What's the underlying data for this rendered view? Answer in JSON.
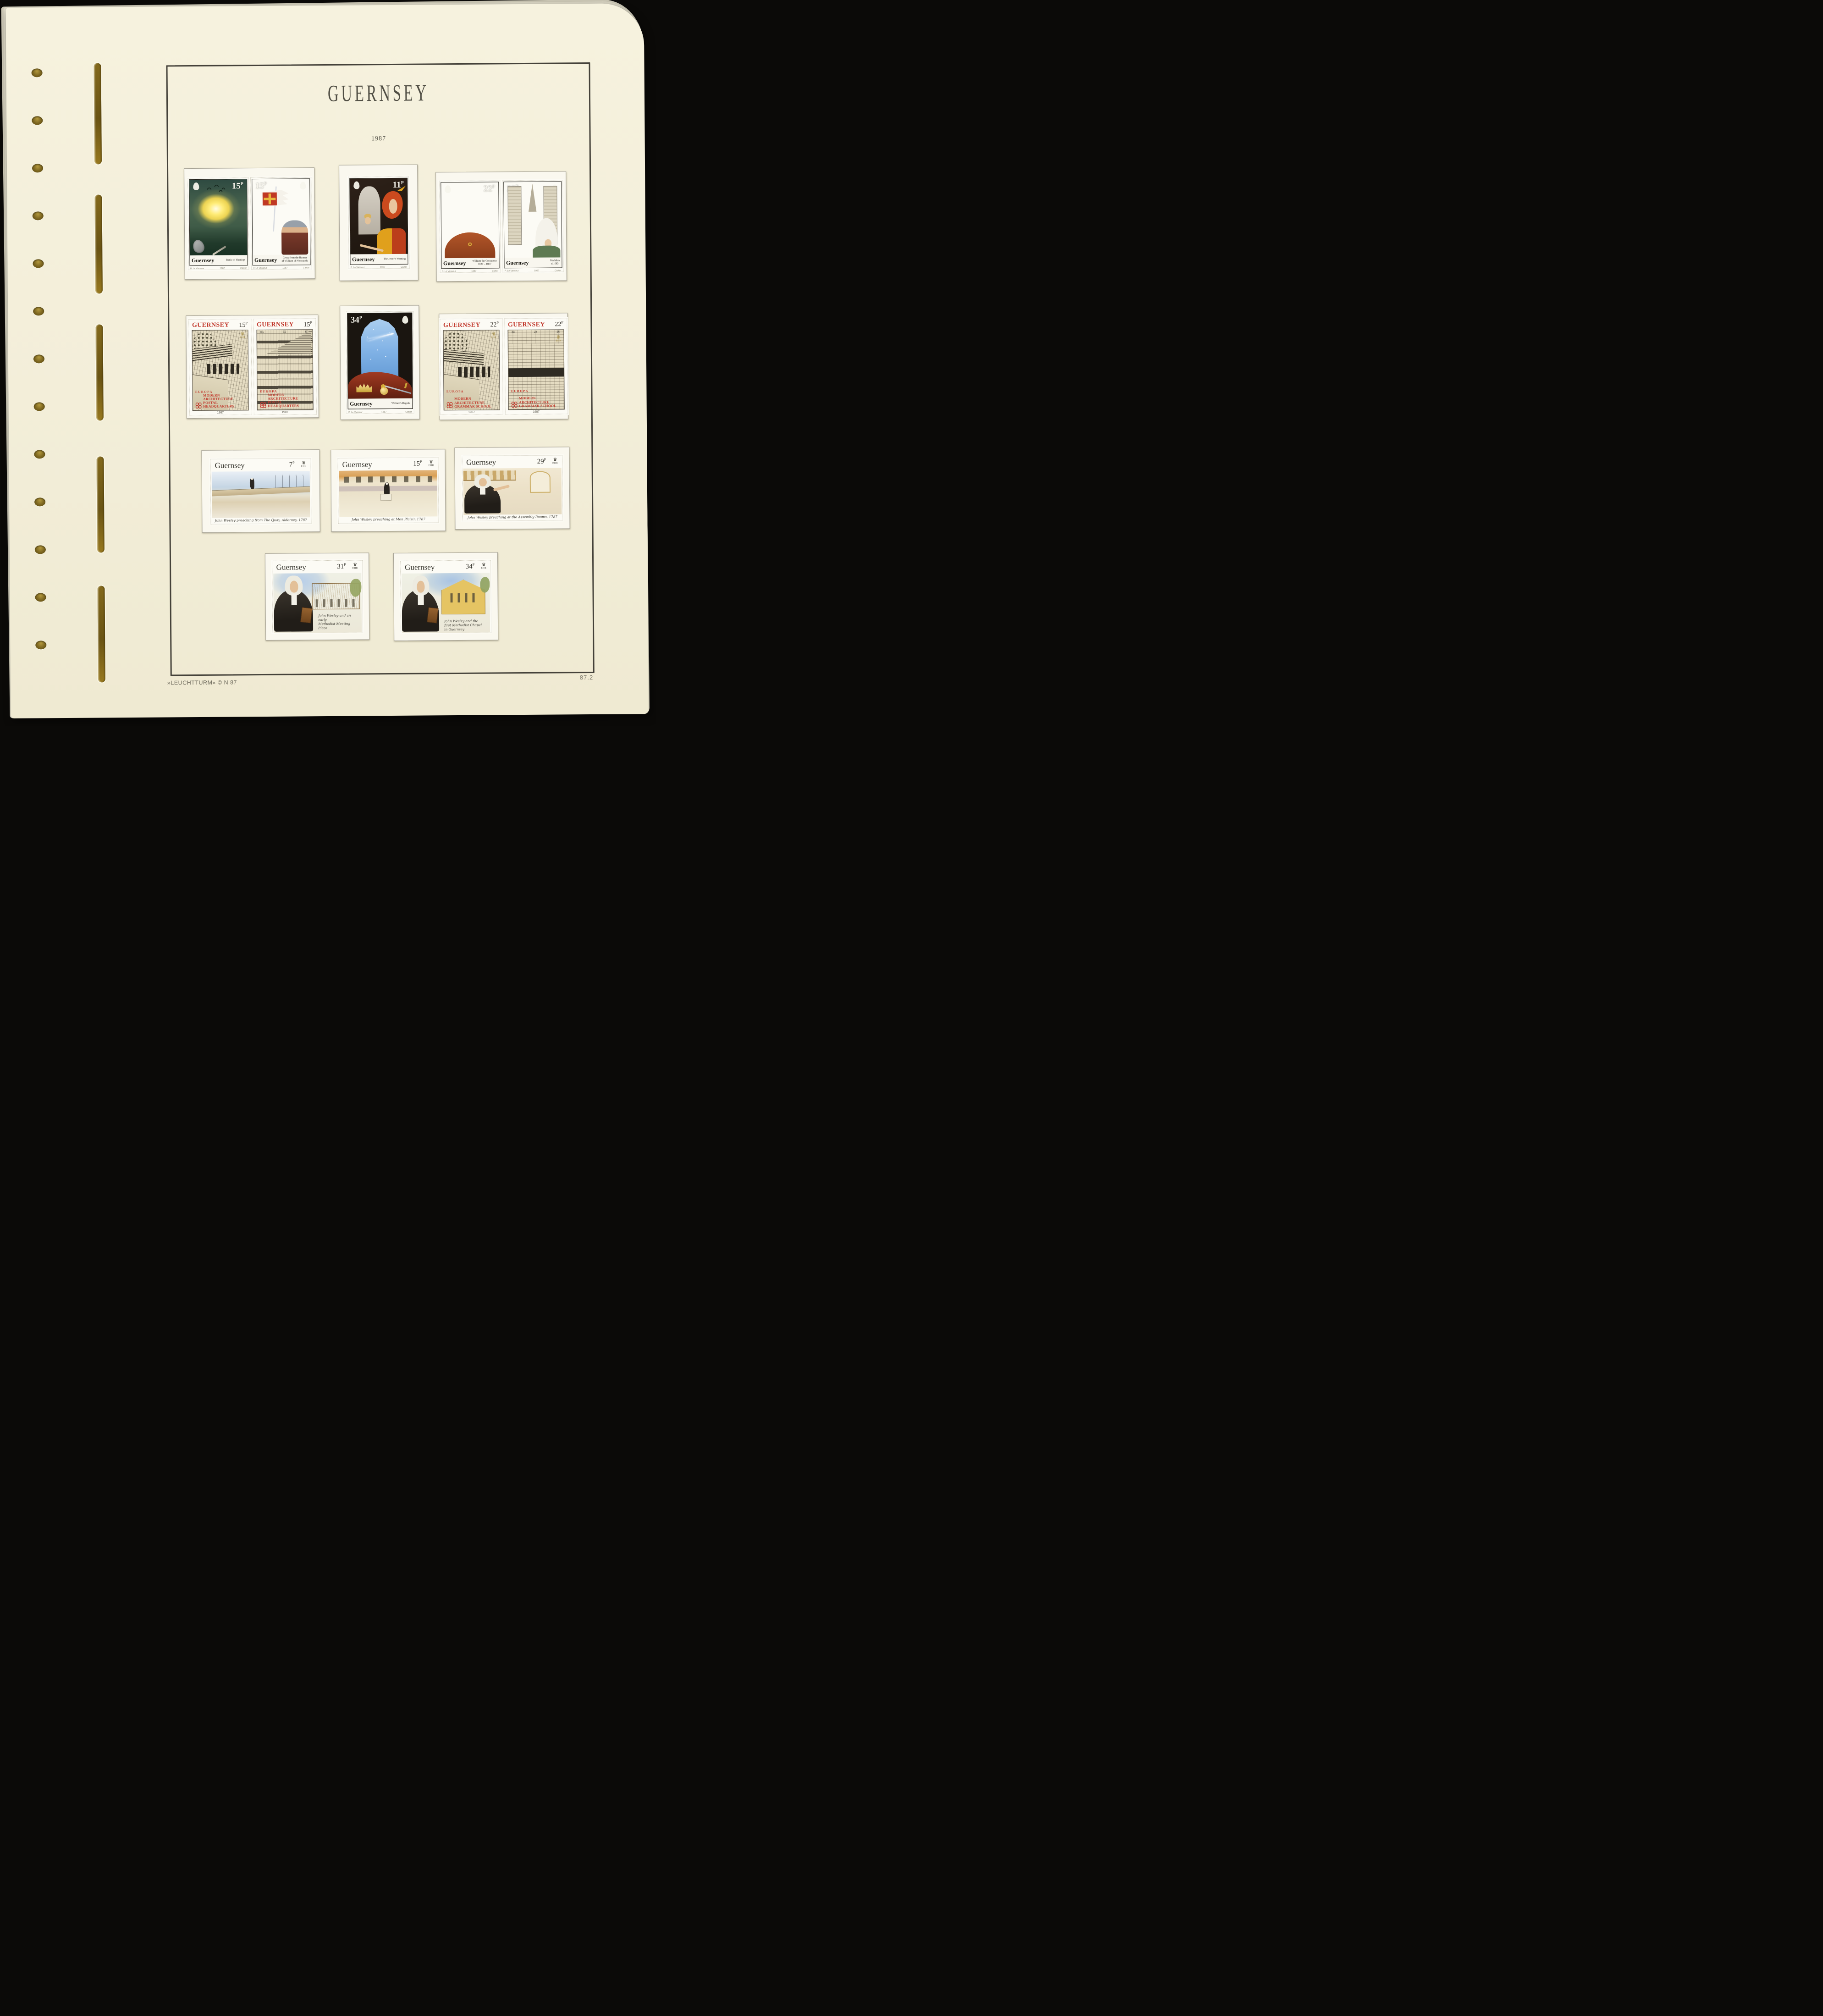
{
  "album": {
    "title": "GUERNSEY",
    "year": "1987"
  },
  "footer": {
    "publisher": "»LEUCHTTURM«  © N 87",
    "page_number": "87.2"
  },
  "stamps": {
    "s1": {
      "country": "Guernsey",
      "value": "15",
      "p": "P",
      "caption": "Battle of Hastings",
      "artist": "P. Le Vasseur",
      "year": "1987",
      "printer": "Cartor"
    },
    "s2": {
      "country": "Guernsey",
      "value": "15",
      "p": "P",
      "caption_line1": "Cross from the Banner",
      "caption_line2": "of William of Normandy",
      "artist": "P. Le Vasseur",
      "year": "1987",
      "printer": "Cartor"
    },
    "s3": {
      "country": "Guernsey",
      "value": "11",
      "p": "P",
      "caption": "The Jester's Warning",
      "artist": "P. Le Vasseur",
      "year": "1987",
      "printer": "Cartor"
    },
    "s4": {
      "country": "Guernsey",
      "value": "22",
      "p": "P",
      "caption_line1": "William the Conqueror",
      "caption_line2": "1027 – 1087",
      "artist": "P. Le Vasseur",
      "year": "1987",
      "printer": "Cartor"
    },
    "s5": {
      "country": "Guernsey",
      "value": "22",
      "p": "P",
      "caption_line1": "Mathilda",
      "caption_line2": "d.1083",
      "artist": "P. Le Vasseur",
      "year": "1987",
      "printer": "Cartor"
    },
    "s6": {
      "country": "GUERNSEY",
      "value": "15",
      "p": "P",
      "europa": "EUROPA",
      "caption_line1": "MODERN ARCHITECTURE",
      "caption_line2": "POSTAL HEADQUARTERS",
      "year": "1987",
      "royal": "EIIR"
    },
    "s7": {
      "country": "GUERNSEY",
      "value": "15",
      "p": "P",
      "europa": "EUROPA",
      "caption_line1": "MODERN ARCHITECTURE",
      "caption_line2": "POSTAL HEADQUARTERS",
      "year": "1987",
      "royal": "EIIR",
      "marks": [
        "E1",
        "E2",
        "E3"
      ]
    },
    "s8": {
      "country": "Guernsey",
      "value": "34",
      "p": "P",
      "caption": "William's Regalia",
      "artist": "P. Le Vasseur",
      "year": "1987",
      "printer": "Cartor"
    },
    "s9": {
      "country": "GUERNSEY",
      "value": "22",
      "p": "P",
      "europa": "EUROPA",
      "caption_line1": "MODERN ARCHITECTURE",
      "caption_line2": "GRAMMAR SCHOOL",
      "year": "1987",
      "royal": "EIIR"
    },
    "s10": {
      "country": "GUERNSEY",
      "value": "22",
      "p": "P",
      "europa": "EUROPA",
      "caption_line1": "MODERN ARCHITECTURE",
      "caption_line2": "GRAMMAR SCHOOL",
      "year": "1987",
      "royal": "EIIR",
      "marks": [
        "23",
        "24",
        "25"
      ]
    },
    "s11": {
      "country": "Guernsey",
      "value": "7",
      "p": "P",
      "royal": "EIIR",
      "caption": "John Wesley preaching from The Quay, Alderney, 1787"
    },
    "s12": {
      "country": "Guernsey",
      "value": "15",
      "p": "P",
      "royal": "EIIR",
      "caption": "John Wesley preaching at Mon Plaisir, 1787"
    },
    "s13": {
      "country": "Guernsey",
      "value": "29",
      "p": "P",
      "royal": "EIIR",
      "caption": "John Wesley preaching at the Assembly Rooms, 1787"
    },
    "s14": {
      "country": "Guernsey",
      "value": "31",
      "p": "P",
      "royal": "EIIR",
      "caption_lines": [
        "John Wesley and an early",
        "Methodist Meeting Place"
      ]
    },
    "s15": {
      "country": "Guernsey",
      "value": "34",
      "p": "P",
      "royal": "EIIR",
      "caption_lines": [
        "John Wesley and the",
        "first Methodist Chapel",
        "in Guernsey"
      ]
    }
  }
}
